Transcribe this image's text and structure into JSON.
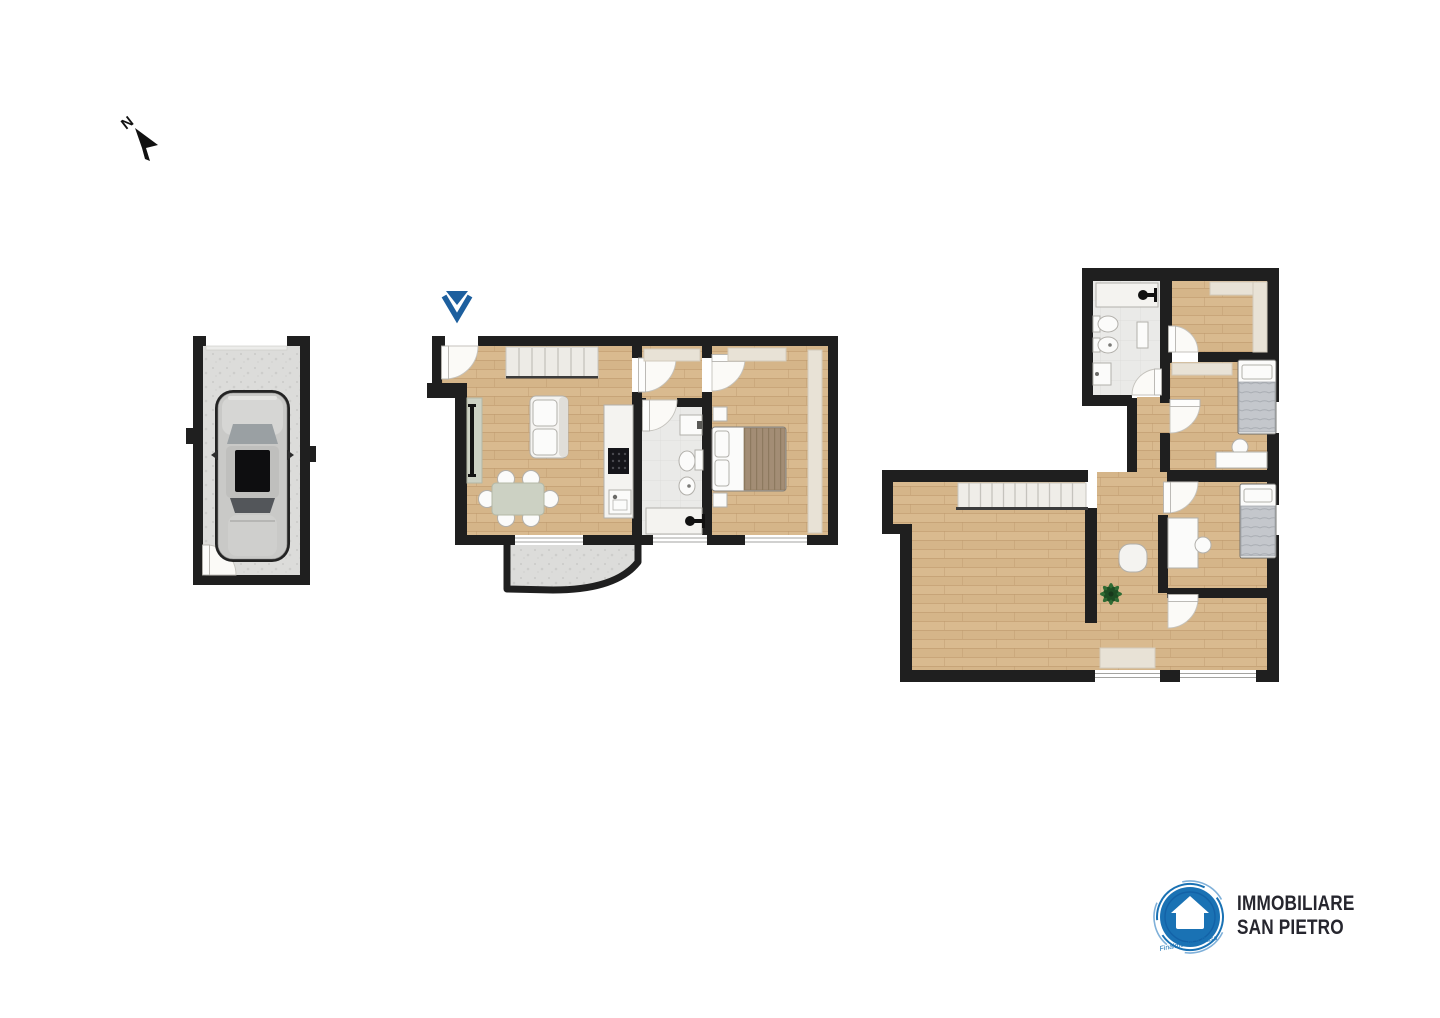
{
  "compass": {
    "label": "N"
  },
  "logo": {
    "line1": "IMMOBILIARE",
    "line2": "SAN PIETRO",
    "tagline": "Finalmente a Casa"
  },
  "colors": {
    "wall": "#1f1f1f",
    "wood": "#d9ba8f",
    "woodAlt": "#d1b083",
    "woodLine": "#c09b6f",
    "concrete": "#dcdcda",
    "concreteDot": "#cdcdcb",
    "bath": "#eaeae8",
    "bathLine": "#dedddb",
    "white": "#fbfbfa",
    "furn": "#f4f3f0",
    "furnStroke": "#b2b0ab",
    "wardrobe": "#e8e2d6",
    "wardrobeStroke": "#d2cbbc",
    "sage": "#ccd1c3",
    "sageStroke": "#b3b8a6",
    "tv": "#141414",
    "blanketBrown": "#a38d75",
    "blanketGray": "#c4c7cc",
    "plant": "#2e6b33",
    "plantDark": "#1e4d24",
    "brand": "#1a72b4",
    "brandDark": "#0f59a0",
    "brandLight": "#7fb0d9",
    "marker": "#1d5f9e",
    "text": "#26262e",
    "arrow": "#111111"
  }
}
